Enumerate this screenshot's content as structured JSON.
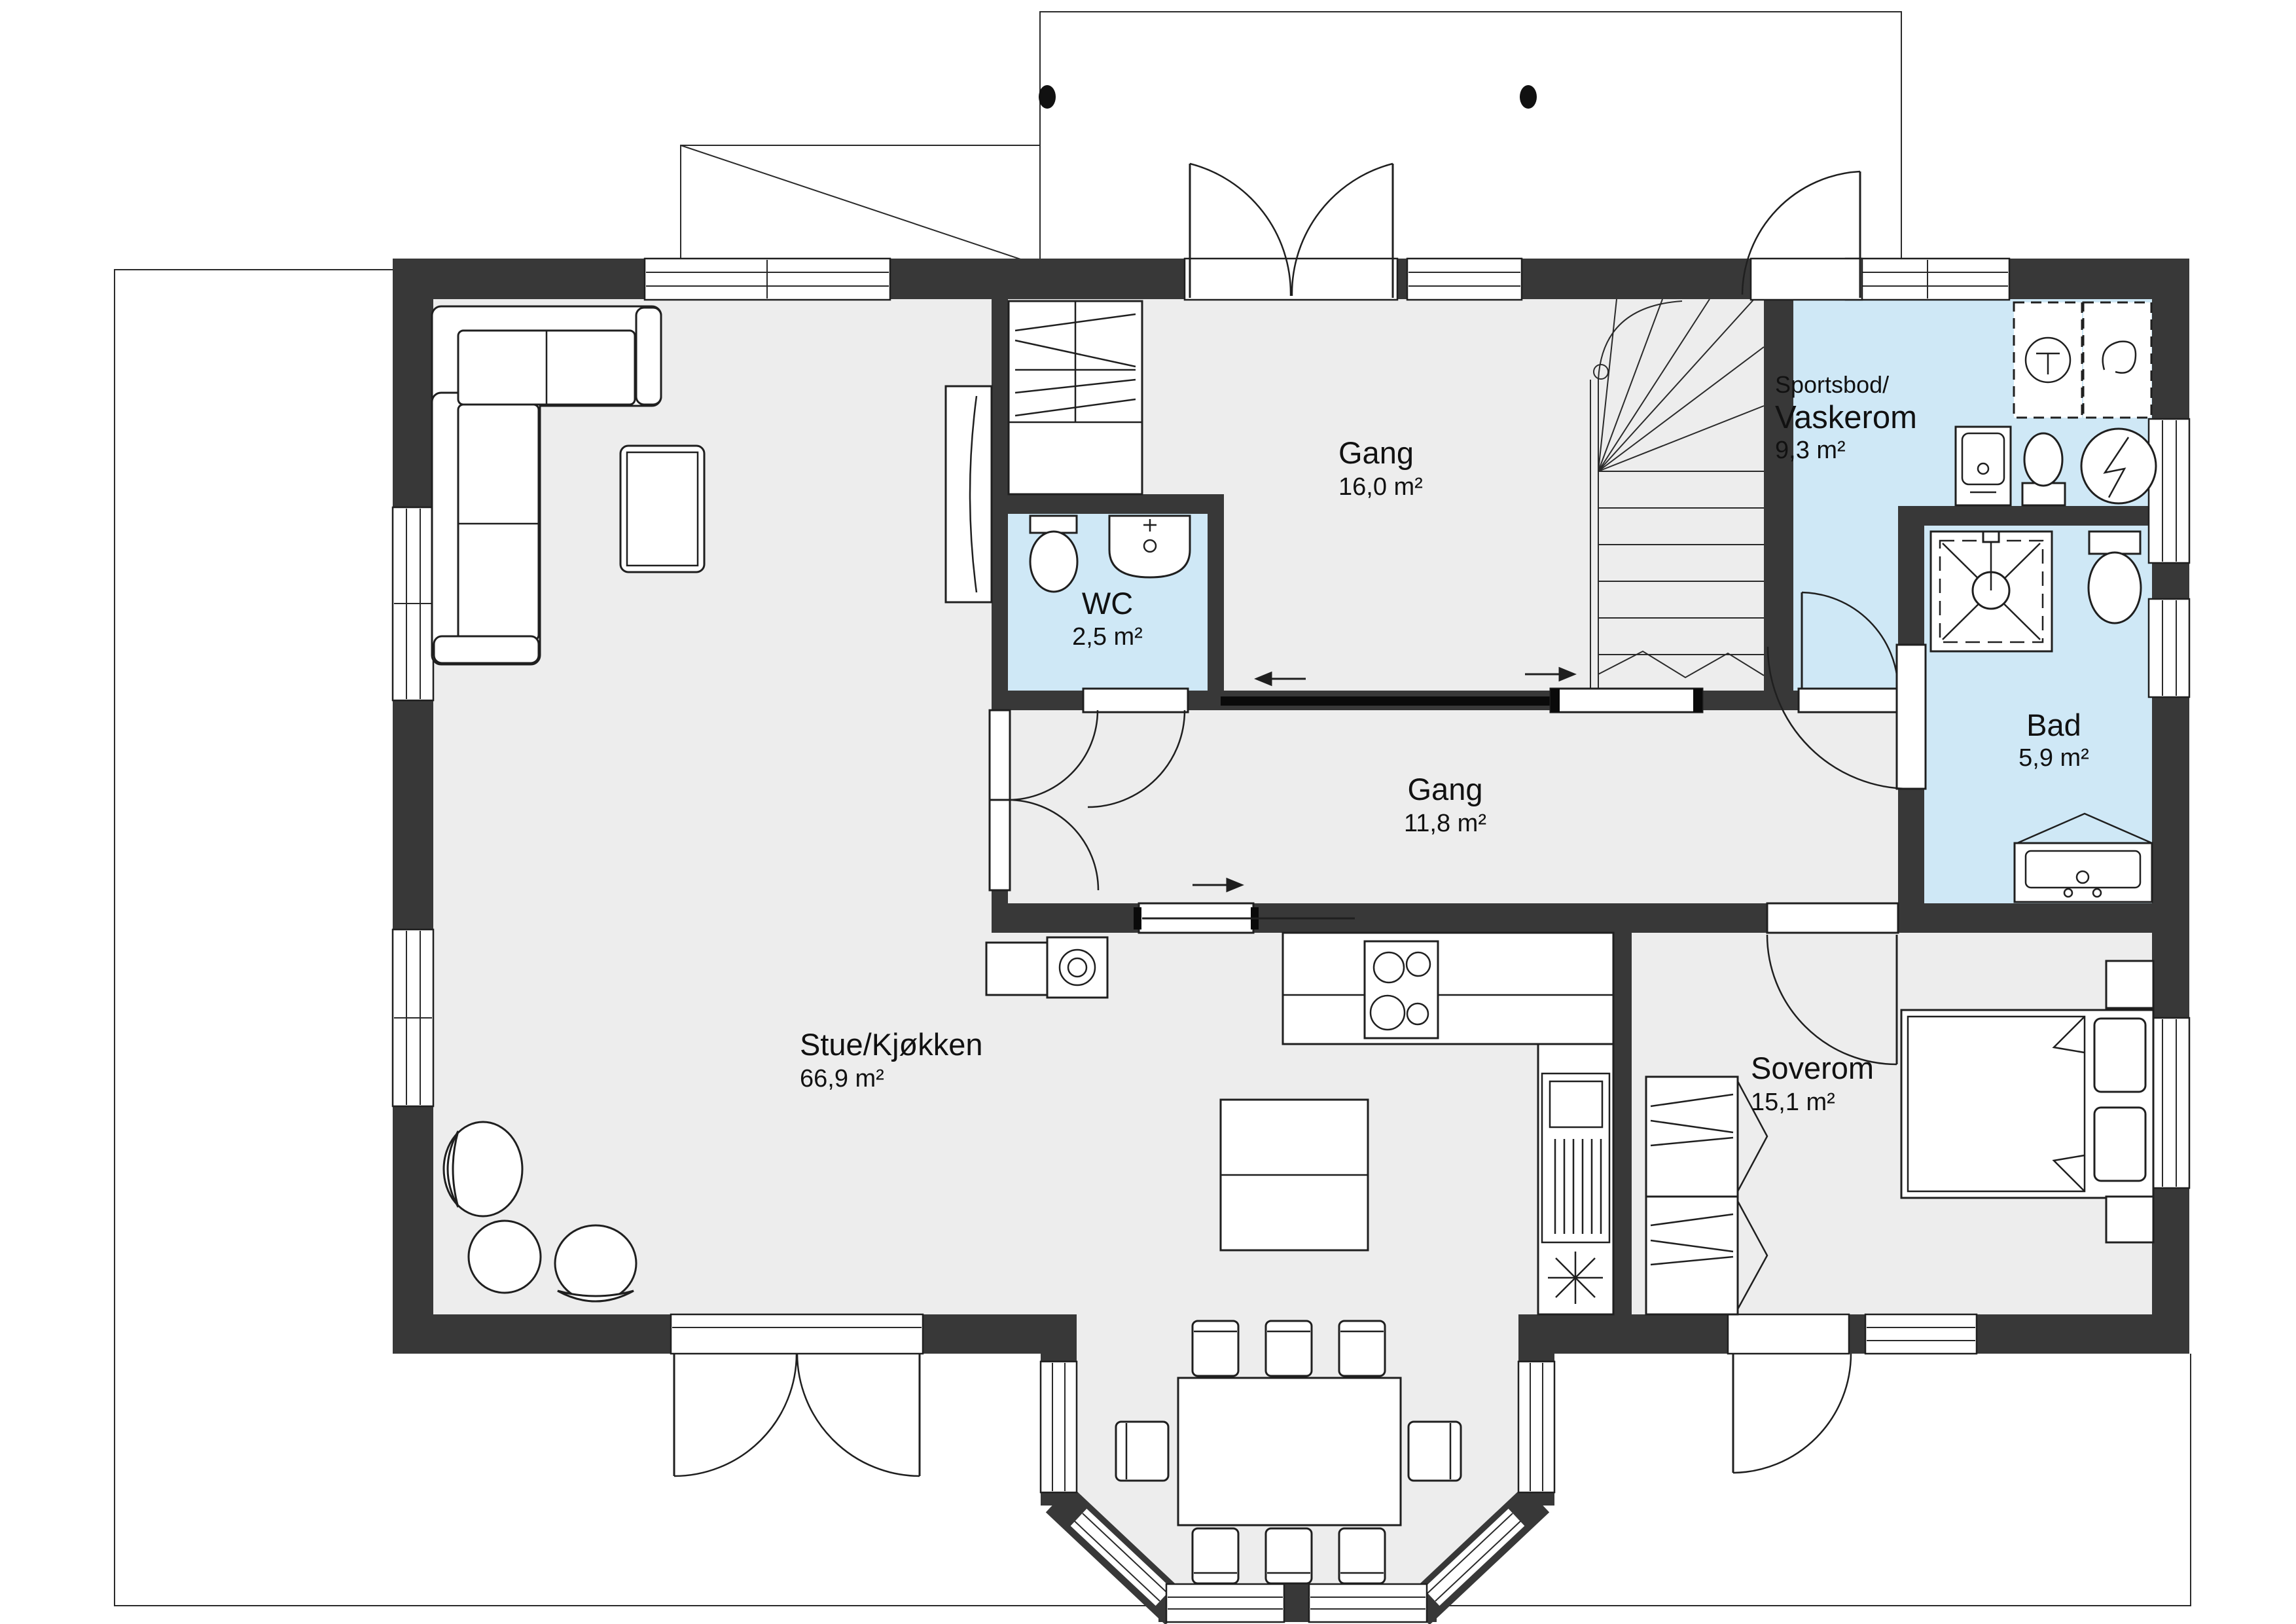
{
  "plan": {
    "title": "Floor plan – first floor",
    "rooms": [
      {
        "id": "stue",
        "name": "Stue/Kjøkken",
        "area": "66,9 m²"
      },
      {
        "id": "gang1",
        "name": "Gang",
        "area": "16,0 m²"
      },
      {
        "id": "vaskerom",
        "name_line1": "Sportsbod/",
        "name_line2": "Vaskerom",
        "area": "9,3 m²"
      },
      {
        "id": "wc",
        "name": "WC",
        "area": "2,5 m²"
      },
      {
        "id": "gang2",
        "name": "Gang",
        "area": "11,8 m²"
      },
      {
        "id": "bad",
        "name": "Bad",
        "area": "5,9 m²"
      },
      {
        "id": "soverom",
        "name": "Soverom",
        "area": "15,1 m²"
      }
    ],
    "fixtures": [
      "staircase",
      "washer",
      "dryer",
      "water-heater",
      "laundry-sink",
      "toilet",
      "shower",
      "vanity-sink",
      "wood-stove",
      "kitchen-counter",
      "cooktop",
      "kitchen-island",
      "dining-table",
      "corner-sofa",
      "coffee-table",
      "armchair",
      "pouf",
      "double-bed",
      "nightstand",
      "wardrobe",
      "tv"
    ],
    "colors": {
      "wall": "#383838",
      "floor": "#ededed",
      "wet_room": "#cfe8f6",
      "line": "#1f1f1f",
      "background": "#ffffff"
    }
  }
}
